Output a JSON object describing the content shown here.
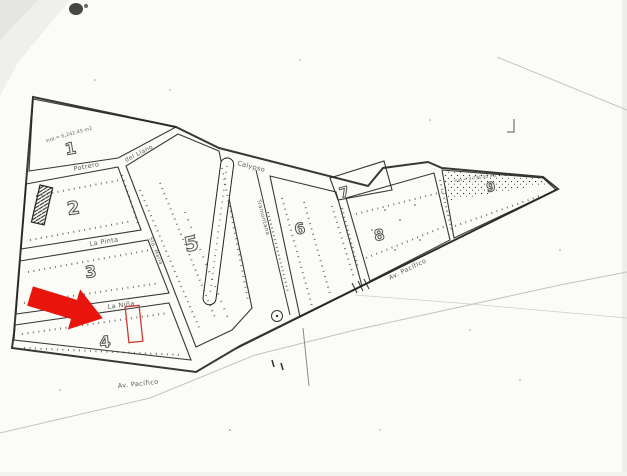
{
  "map": {
    "blocks": [
      {
        "number": "1",
        "area": "sup.= 6,242.45 m2"
      },
      {
        "number": "2"
      },
      {
        "number": "3"
      },
      {
        "number": "4"
      },
      {
        "number": "5"
      },
      {
        "number": "6"
      },
      {
        "number": "7"
      },
      {
        "number": "8"
      },
      {
        "number": "9",
        "area": "sup.= 3,736.00 m2"
      }
    ],
    "streets": {
      "potrero": "Potrero",
      "del_llano": "del Llano",
      "la_pinta": "La Pinta",
      "la_nina": "La Niña",
      "sta_maria": "Sta. María",
      "calypso": "Calypso",
      "tramontana": "Tramontana",
      "av_pacifico_right": "Av. Pacífico",
      "av_pacifico_bottom": "Av. Pacífico"
    },
    "annotations": {
      "arrow_color": "#e8150d",
      "lot_outline_color": "#cc3b35"
    }
  }
}
